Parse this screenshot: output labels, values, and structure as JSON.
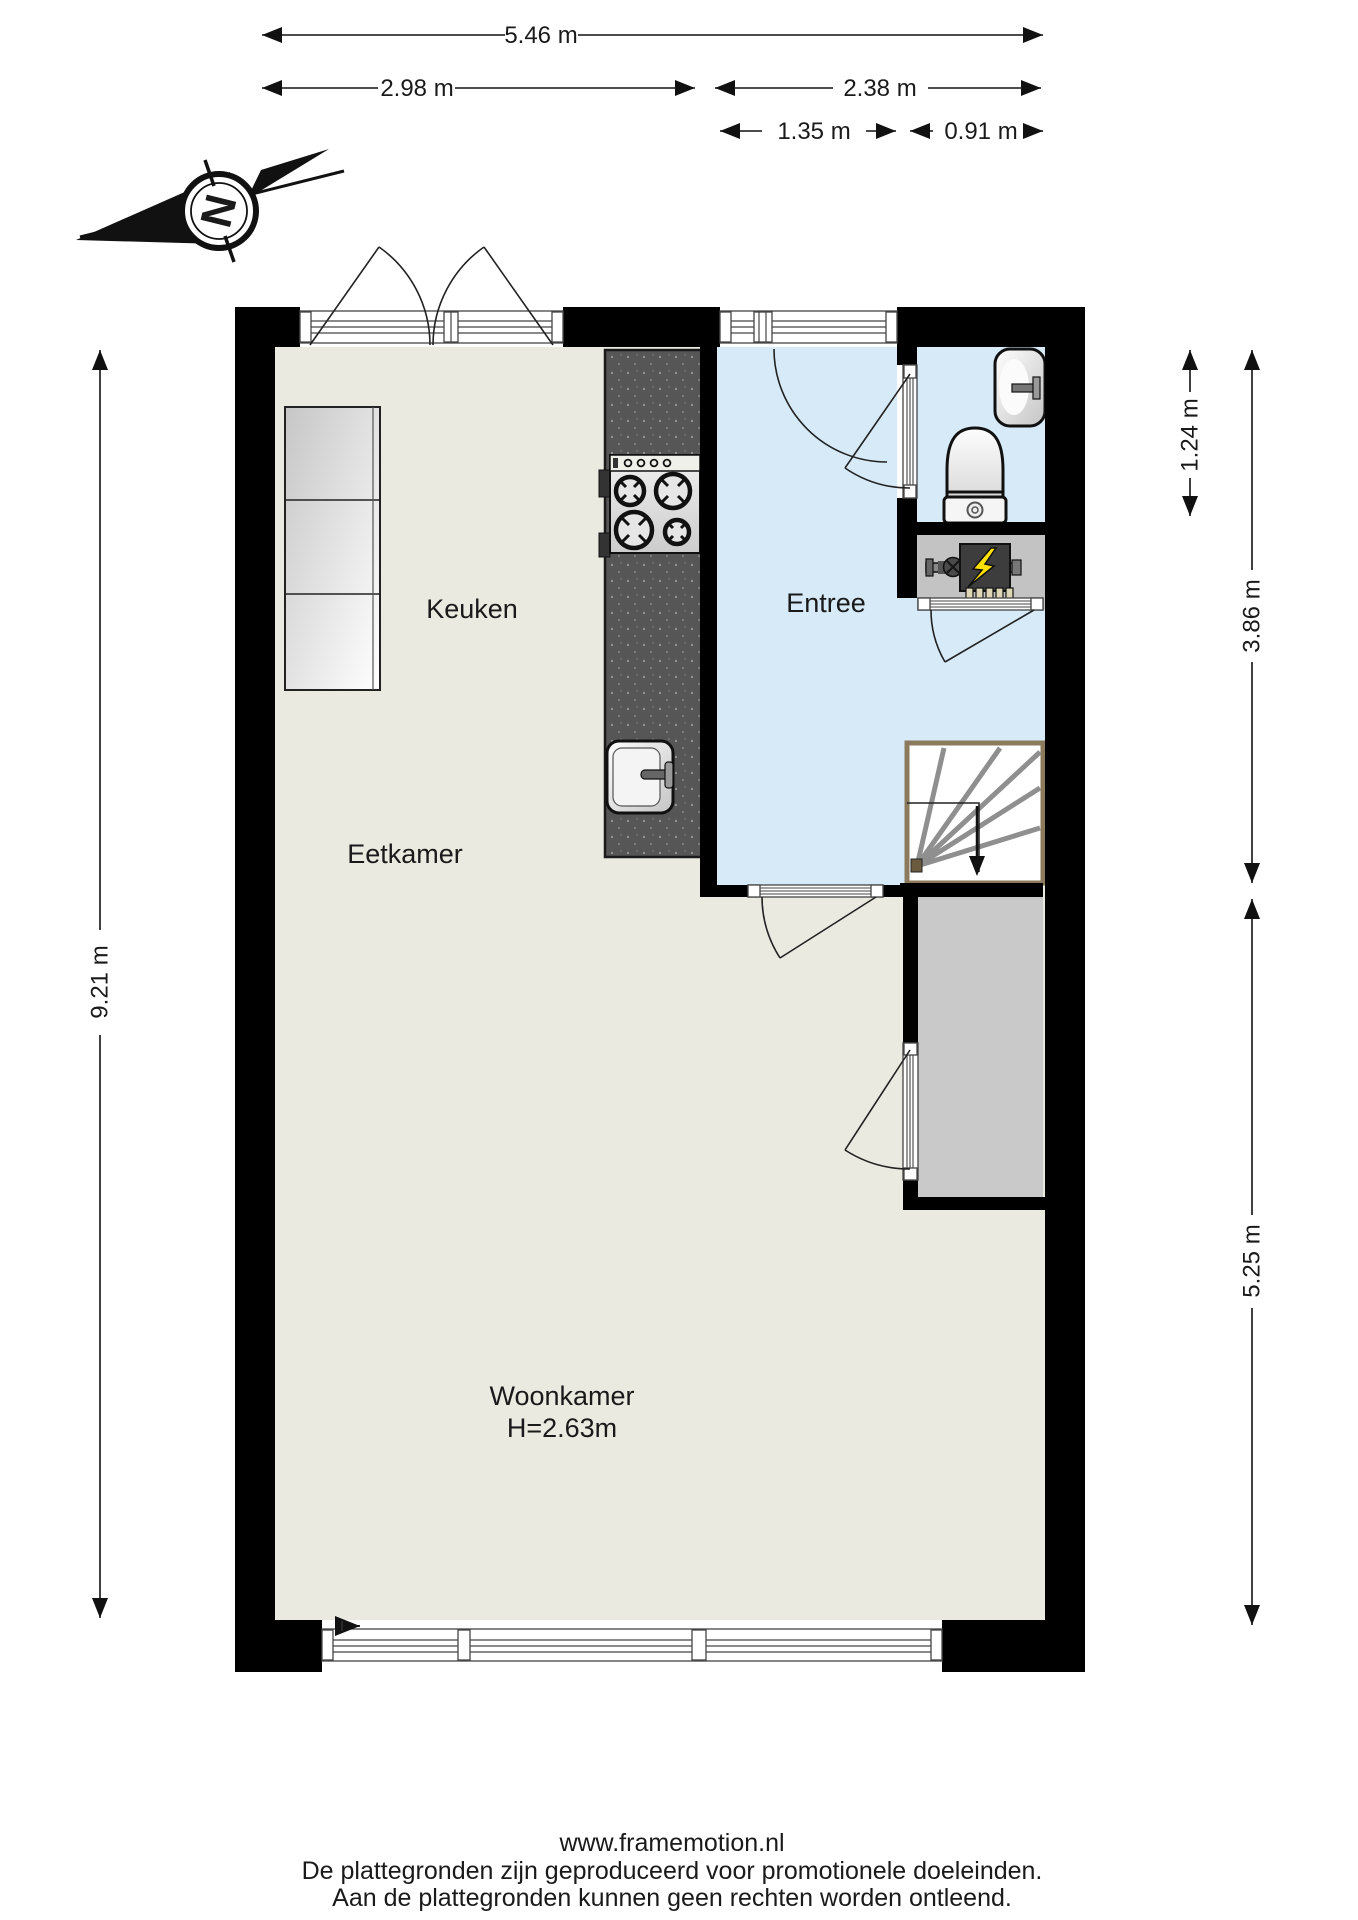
{
  "rooms": {
    "keuken": "Keuken",
    "entree": "Entree",
    "eetkamer": "Eetkamer",
    "woonkamer": "Woonkamer",
    "woonkamer_ceiling_height": "H=2.63m"
  },
  "dimensions": {
    "total_width": "5.46 m",
    "left_width": "2.98 m",
    "right_width": "2.38 m",
    "entree_width": "1.35 m",
    "stairs_width": "0.91 m",
    "total_height": "9.21 m",
    "bathroom_height": "1.24 m",
    "entree_height": "3.86 m",
    "woonkamer_height": "5.25 m"
  },
  "compass": {
    "north_letter": "N"
  },
  "footer": {
    "website": "www.framemotion.nl",
    "disclaimer_1": "De plattegronden zijn geproduceerd voor promotionele doeleinden.",
    "disclaimer_2": "Aan de plattegronden kunnen geen rechten worden ontleend."
  },
  "colors": {
    "wall": "#000000",
    "living_floor": "#eaeae0",
    "entree_floor": "#d7eaf8",
    "bathroom_floor": "#d7eaf8",
    "meter_floor": "#c3c3c3",
    "closet_floor": "#c9c9c9",
    "counter": "#565656",
    "stairs_border": "#8b7a5c",
    "tread_gray": "#8f8f8f",
    "bolt_yellow": "#ffe100"
  }
}
